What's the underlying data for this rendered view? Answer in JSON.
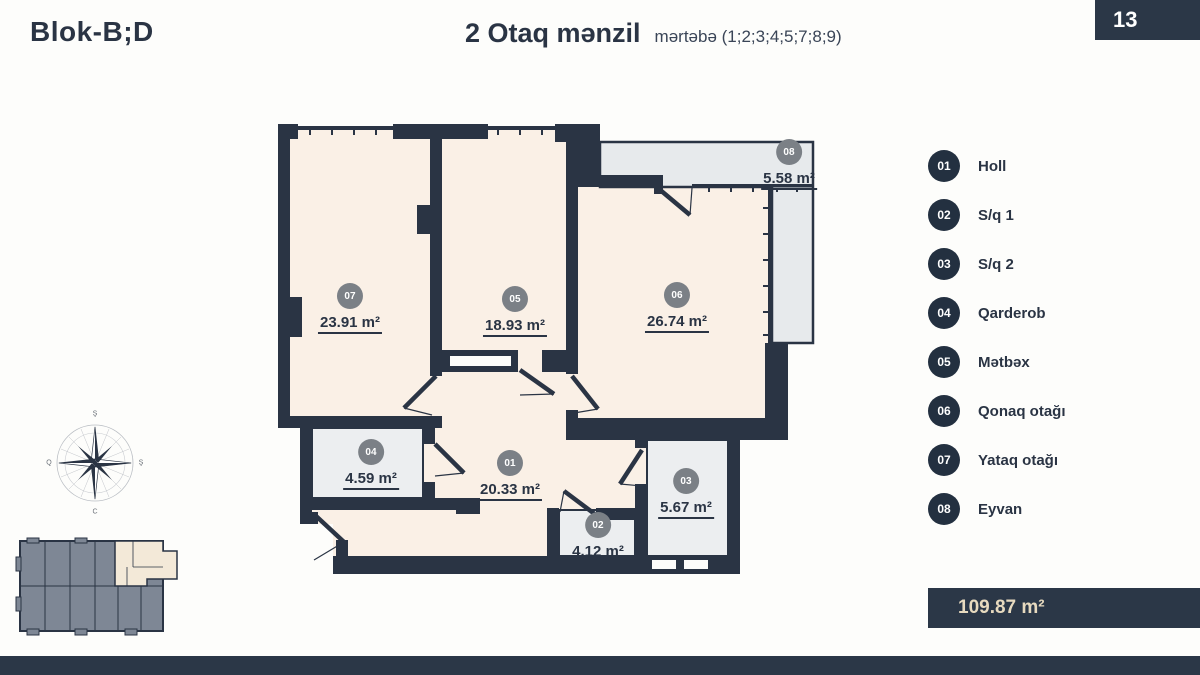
{
  "header": {
    "block": "Blok-B;D",
    "title": "2 Otaq mənzil",
    "subtitle": "mərtəbə (1;2;3;4;5;7;8;9)",
    "page": "13"
  },
  "rooms": [
    {
      "num": "01",
      "area": "20.33 m²"
    },
    {
      "num": "02",
      "area": "4.12 m²"
    },
    {
      "num": "03",
      "area": "5.67 m²"
    },
    {
      "num": "04",
      "area": "4.59 m²"
    },
    {
      "num": "05",
      "area": "18.93 m²"
    },
    {
      "num": "06",
      "area": "26.74 m²"
    },
    {
      "num": "07",
      "area": "23.91 m²"
    },
    {
      "num": "08",
      "area": "5.58 m²"
    }
  ],
  "legend": [
    {
      "num": "01",
      "label": "Holl"
    },
    {
      "num": "02",
      "label": "S/q 1"
    },
    {
      "num": "03",
      "label": "S/q 2"
    },
    {
      "num": "04",
      "label": "Qarderob"
    },
    {
      "num": "05",
      "label": "Mətbəx"
    },
    {
      "num": "06",
      "label": "Qonaq otağı"
    },
    {
      "num": "07",
      "label": "Yataq otağı"
    },
    {
      "num": "08",
      "label": "Eyvan"
    }
  ],
  "total_area": "109.87 m²",
  "compass": {
    "top": "Ş",
    "right": "Ş",
    "bottom": "C",
    "left": "Q"
  },
  "colors": {
    "wall": "#2a3444",
    "room_fill": "#faf0e6",
    "wet_room_fill": "#eceef0",
    "balcony_fill": "#e7eaec",
    "room_badge": "#7b8086",
    "legend_badge": "#233040",
    "dark_box": "#2b3747",
    "total_text": "#e7dabf"
  }
}
